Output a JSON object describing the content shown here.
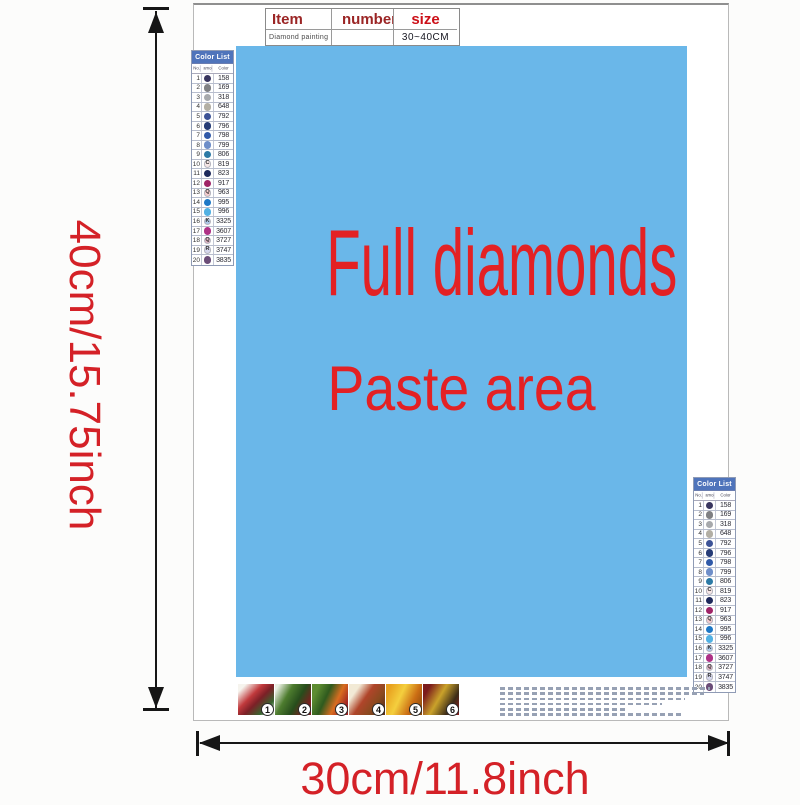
{
  "colors": {
    "paste_bg": "#6ab7e9",
    "accent_red": "#e32124",
    "dim_red": "#d42127",
    "table_red": "#9b2525",
    "size_red": "#cc1018",
    "list_header_bg": "#4f74bb"
  },
  "item_table": {
    "headers": [
      "Item",
      "number",
      "size"
    ],
    "row": [
      "Diamond painting",
      "",
      "30~40CM"
    ]
  },
  "paste_area": {
    "title": "Full diamonds",
    "subtitle": "Paste area"
  },
  "size_labels": {
    "vertical": "40cm/15.75inch",
    "horizontal": "30cm/11.8inch"
  },
  "color_list": {
    "title": "Color List",
    "columns": [
      "No.",
      "Diamond",
      "Color"
    ],
    "rows": [
      {
        "no": "1",
        "code": "158",
        "hex": "#39365f",
        "letter": "",
        "light": false
      },
      {
        "no": "2",
        "code": "169",
        "hex": "#7f8083",
        "letter": "",
        "light": false
      },
      {
        "no": "3",
        "code": "318",
        "hex": "#a7a9ac",
        "letter": "",
        "light": false
      },
      {
        "no": "4",
        "code": "648",
        "hex": "#b3afa4",
        "letter": "",
        "light": false
      },
      {
        "no": "5",
        "code": "792",
        "hex": "#3d5397",
        "letter": "",
        "light": false
      },
      {
        "no": "6",
        "code": "796",
        "hex": "#263c77",
        "letter": "",
        "light": false
      },
      {
        "no": "7",
        "code": "798",
        "hex": "#3059a8",
        "letter": "",
        "light": false
      },
      {
        "no": "8",
        "code": "799",
        "hex": "#6e8ec9",
        "letter": "",
        "light": false
      },
      {
        "no": "9",
        "code": "806",
        "hex": "#2c7aa6",
        "letter": "",
        "light": false
      },
      {
        "no": "10",
        "code": "819",
        "hex": "#f6e6e6",
        "letter": "C",
        "light": true
      },
      {
        "no": "11",
        "code": "823",
        "hex": "#1e2a5c",
        "letter": "",
        "light": false
      },
      {
        "no": "12",
        "code": "917",
        "hex": "#a02568",
        "letter": "",
        "light": false
      },
      {
        "no": "13",
        "code": "963",
        "hex": "#f4cbcd",
        "letter": "Q",
        "light": true
      },
      {
        "no": "14",
        "code": "995",
        "hex": "#1e78c6",
        "letter": "",
        "light": false
      },
      {
        "no": "15",
        "code": "996",
        "hex": "#52b1e3",
        "letter": "",
        "light": false
      },
      {
        "no": "16",
        "code": "3325",
        "hex": "#abc9e9",
        "letter": "K",
        "light": true
      },
      {
        "no": "17",
        "code": "3607",
        "hex": "#ae3186",
        "letter": "",
        "light": false
      },
      {
        "no": "18",
        "code": "3727",
        "hex": "#dcb1c2",
        "letter": "Q",
        "light": true
      },
      {
        "no": "19",
        "code": "3747",
        "hex": "#d6d8ee",
        "letter": "R",
        "light": true
      },
      {
        "no": "20",
        "code": "3835",
        "hex": "#6b4d78",
        "letter": "",
        "light": false
      }
    ]
  },
  "steps": [
    "1",
    "2",
    "3",
    "4",
    "5",
    "6"
  ]
}
